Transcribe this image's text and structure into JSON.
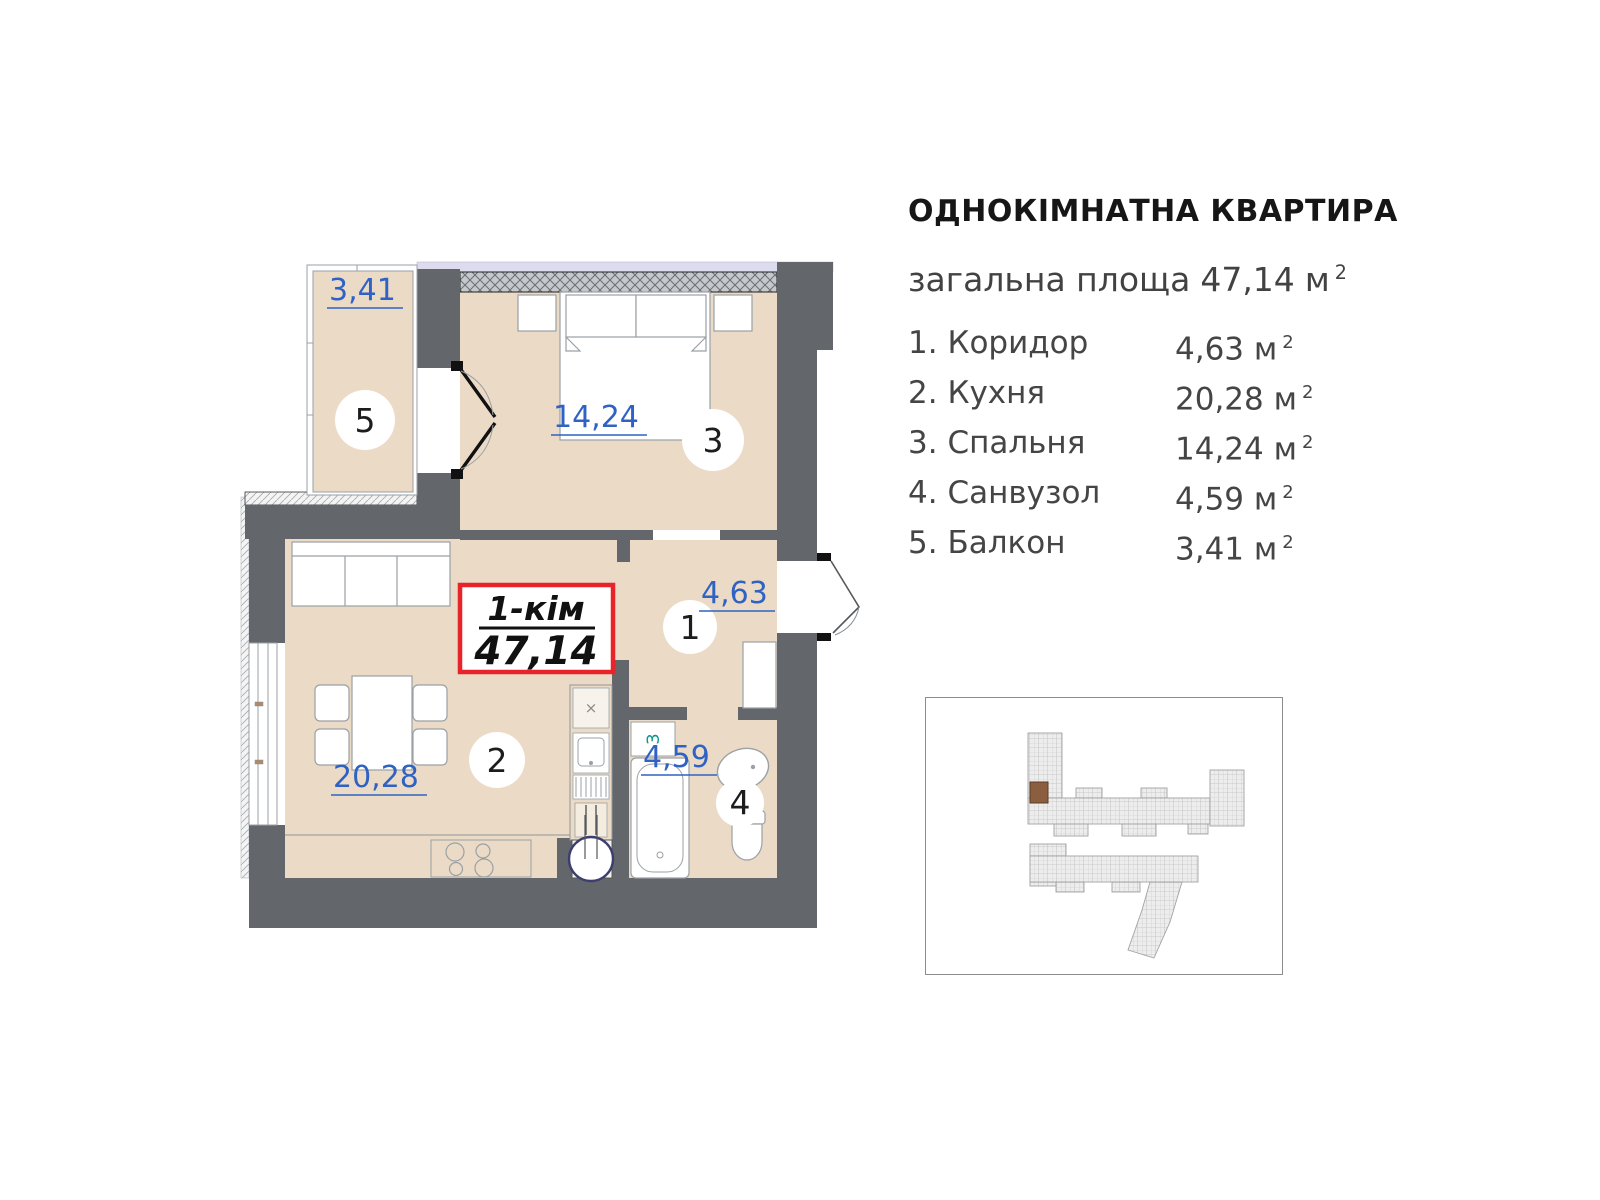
{
  "header": {
    "title": "ОДНОКІМНАТНА КВАРТИРА",
    "total_area_label": "загальна площа",
    "total_area_value": "47,14",
    "total_area_unit": "м",
    "total_area_sup": "2"
  },
  "legend": {
    "unit": "м",
    "sup": "2",
    "rooms": [
      {
        "num": "1.",
        "name": "Коридор",
        "area": "4,63"
      },
      {
        "num": "2.",
        "name": "Кухня",
        "area": "20,28"
      },
      {
        "num": "3.",
        "name": "Спальня",
        "area": "14,24"
      },
      {
        "num": "4.",
        "name": "Санвузол",
        "area": "4,59"
      },
      {
        "num": "5.",
        "name": "Балкон",
        "area": "3,41"
      }
    ]
  },
  "plan": {
    "unit_type_label": "1-кім",
    "unit_area": "47,14",
    "labels": {
      "balcony": "3,41",
      "bedroom": "14,24",
      "kitchen": "20,28",
      "hall": "4,63",
      "bath": "4,59"
    },
    "room_numbers": {
      "hall": "1",
      "kitchen": "2",
      "bedroom": "3",
      "bath": "4",
      "balcony": "5"
    },
    "washer_label": "З"
  },
  "colors": {
    "wall": "#63676c",
    "room_fill": "#ebdbc6",
    "accent_blue": "#2f62c4",
    "accent_red": "#e8232a",
    "window_band": "#dcdcee",
    "washer_teal": "#0e9488",
    "highlight_brown": "#8b5e3f"
  }
}
